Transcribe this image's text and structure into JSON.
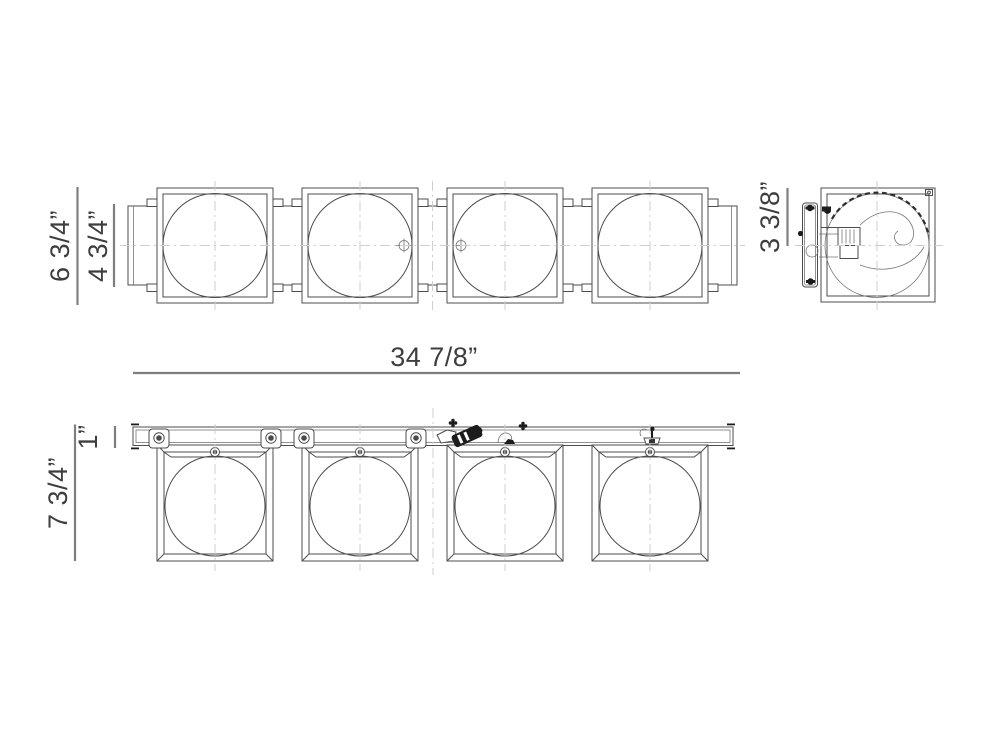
{
  "drawing": {
    "labels": {
      "fixture_depth": "6 3/4”",
      "glass_depth": "4 3/4”",
      "overall_width": "34 7/8”",
      "wall_plate_extension": "3 3/8”",
      "rail_height": "1”",
      "overall_height": "7 3/4”"
    },
    "colors": {
      "line": "#4d4d4d",
      "centerline": "#cfcfcf",
      "dimension_line": "#7e7e7e",
      "text": "#3e3e3e",
      "hardware": "#1c1c1c",
      "background": "#ffffff"
    }
  }
}
